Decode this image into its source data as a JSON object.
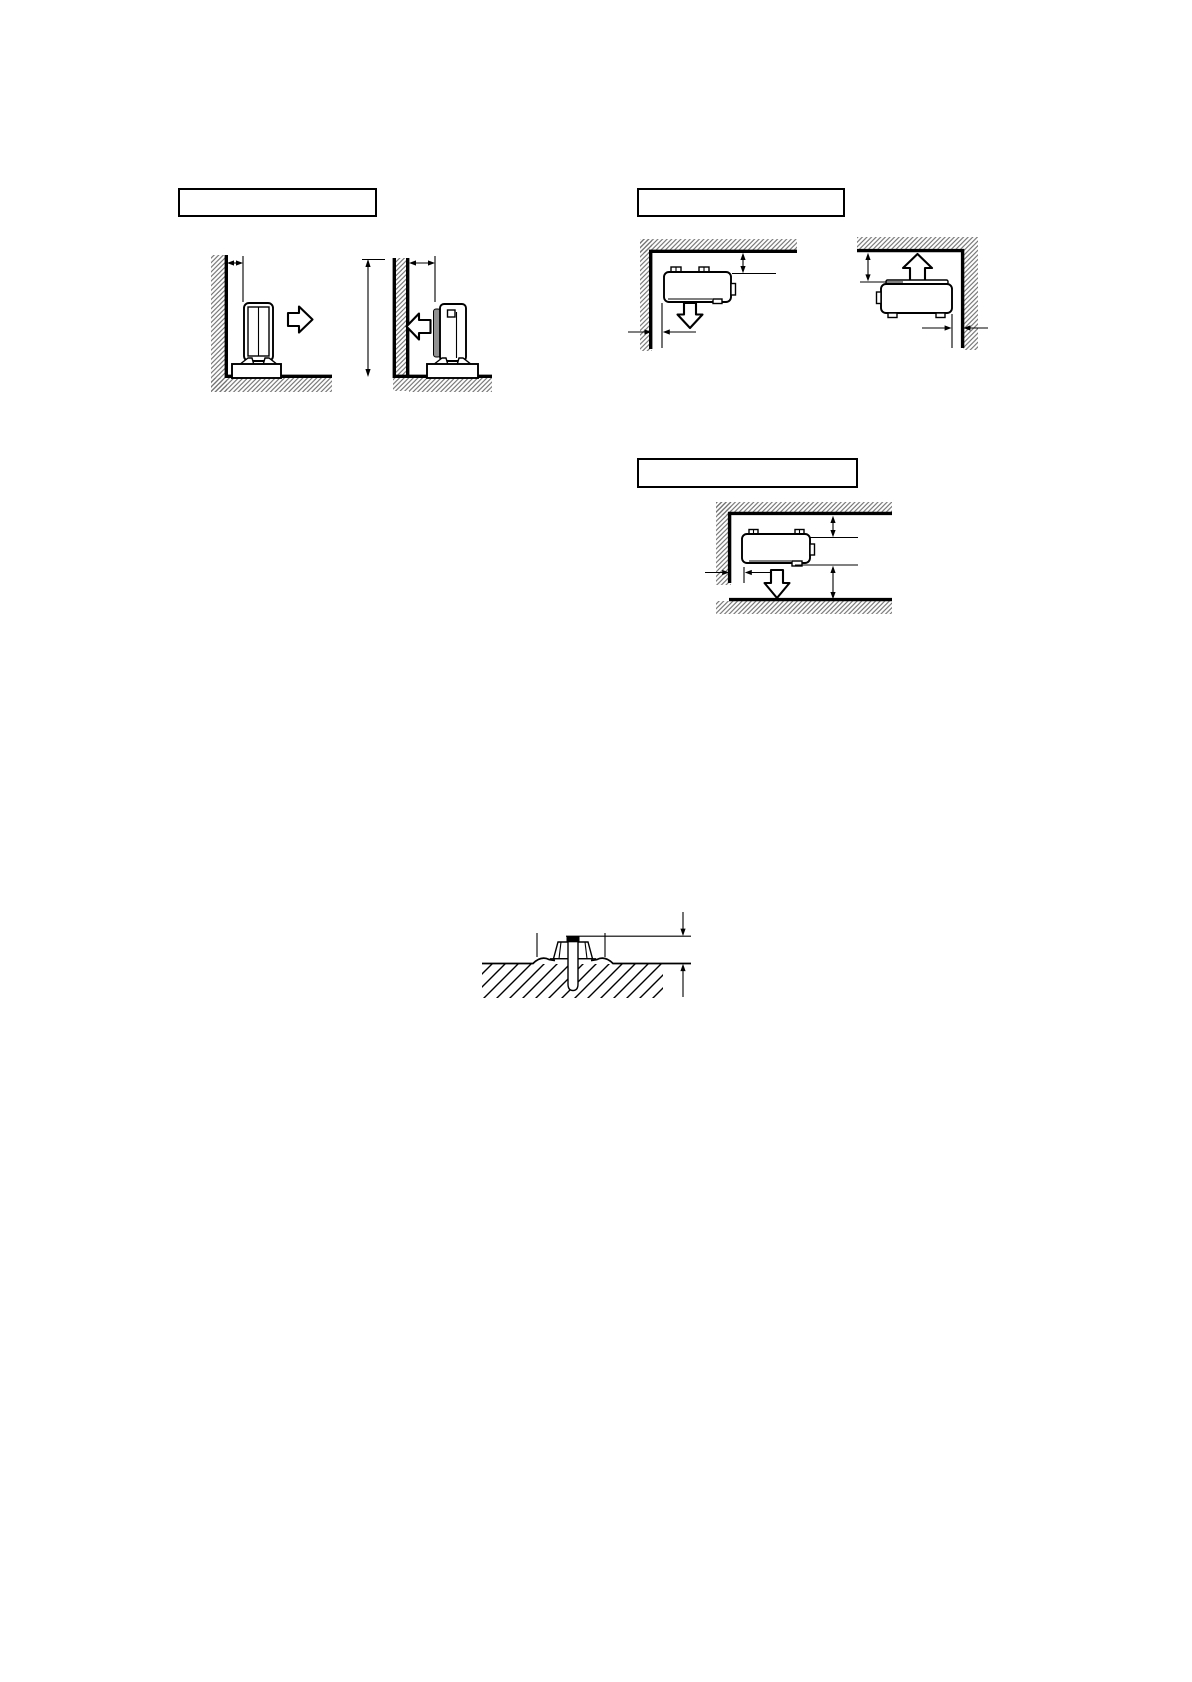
{
  "page": {
    "background_color": "#ffffff",
    "ink_color": "#000000",
    "hatch_line_color": "#6f6f6f",
    "shaded_panel_color": "#909090"
  },
  "sections": {
    "floor_standing_clearance": {
      "caption_box_text": "",
      "figures": [
        {
          "name": "floor-standing-unit-front-toward-wall",
          "airflow_icon": "airflow-right-icon"
        },
        {
          "name": "floor-standing-unit-back-toward-wall",
          "airflow_icon": "airflow-left-icon"
        }
      ]
    },
    "ceiling_suspended_clearance": {
      "caption_box_text": "",
      "figures": [
        {
          "name": "ceiling-corner-unit-downward-blow",
          "airflow_icon": "airflow-down-icon"
        },
        {
          "name": "ceiling-unit-upward-blow",
          "airflow_icon": "airflow-up-icon"
        }
      ]
    },
    "enclosed_space_clearance": {
      "caption_box_text": "",
      "figures": [
        {
          "name": "unit-between-ceiling-and-floor-downward-blow",
          "airflow_icon": "airflow-down-icon"
        }
      ]
    },
    "anchor_bolt_detail": {
      "figures": [
        {
          "name": "anchor-bolt-embedded-in-foundation"
        }
      ]
    }
  }
}
